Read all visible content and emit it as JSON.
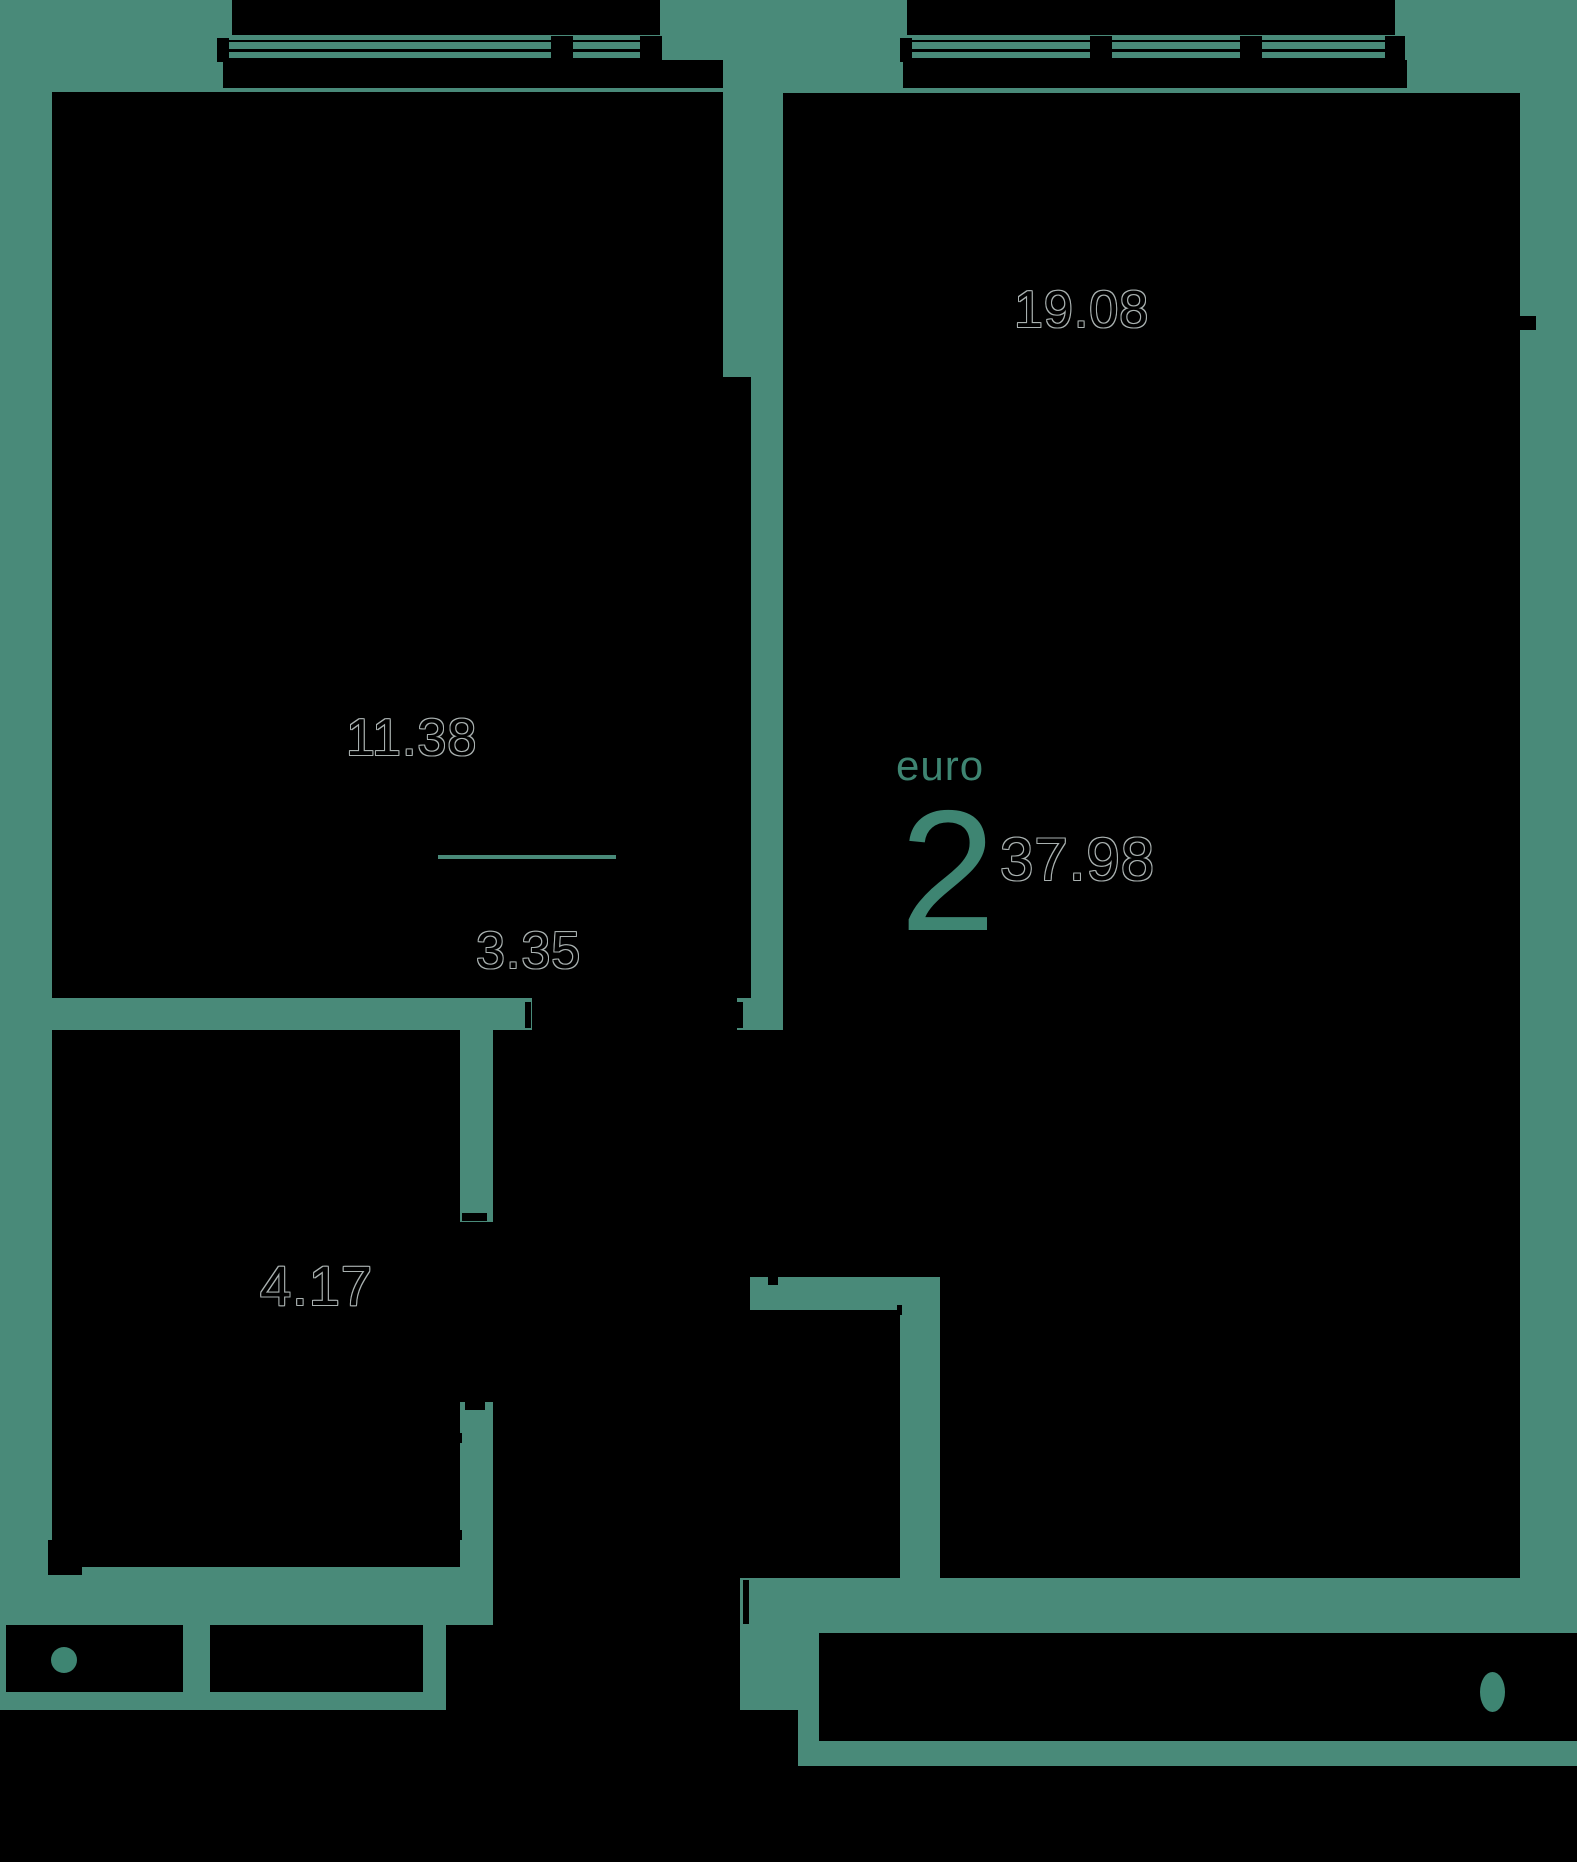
{
  "plan": {
    "type_label": "euro",
    "rooms_count": "2",
    "total_area": "37.98",
    "background_color": "#498a79",
    "room_fill_color": "#000000",
    "accent_text_color": "#3e8572",
    "area_outline_color": "#a9b1b0"
  },
  "rooms": [
    {
      "id": "living",
      "area": "19.08"
    },
    {
      "id": "bedroom",
      "area": "11.38"
    },
    {
      "id": "hallway",
      "area": "3.35"
    },
    {
      "id": "bathroom",
      "area": "4.17"
    }
  ]
}
